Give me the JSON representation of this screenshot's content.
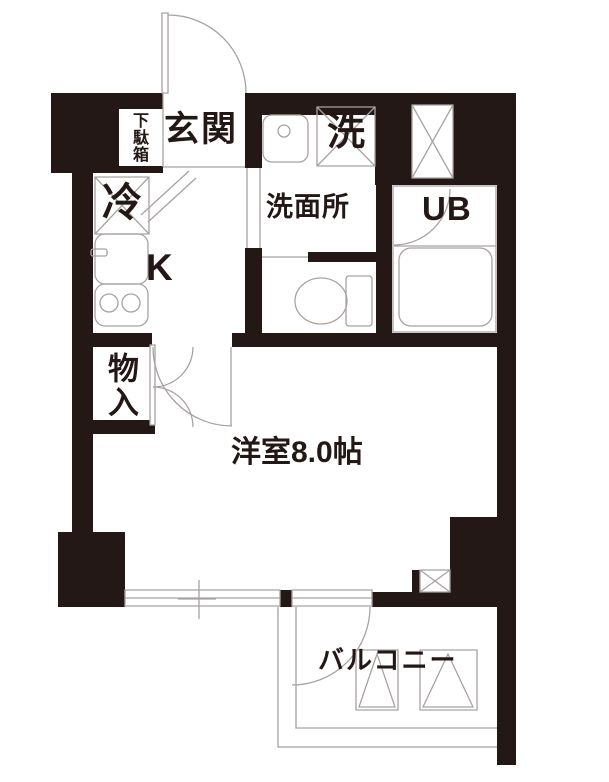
{
  "floorplan": {
    "labels": {
      "entrance": "玄関",
      "shoe_cabinet": "下駄箱",
      "refrigerator": "冷",
      "kitchen": "K",
      "washroom": "洗面所",
      "washing_machine": "洗",
      "unit_bath": "UB",
      "storage": "物入",
      "main_room": "洋室8.0帖",
      "balcony": "バルコニー"
    },
    "colors": {
      "wall": "#231815",
      "line": "#a8a2a2",
      "background": "#ffffff",
      "text": "#231815"
    }
  }
}
